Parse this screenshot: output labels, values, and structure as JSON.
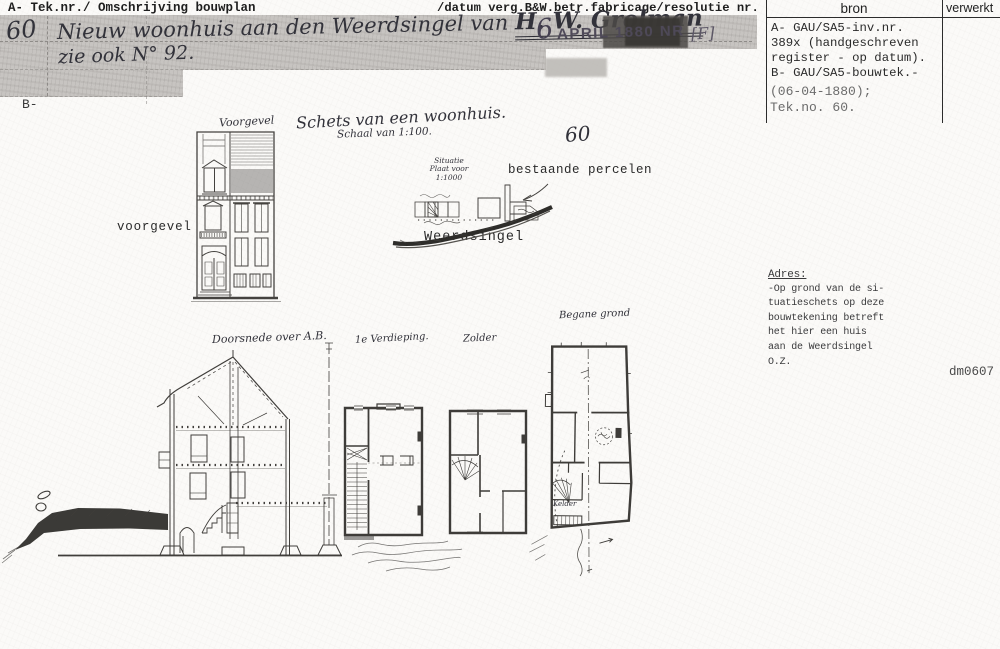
{
  "page": {
    "header_left": "A- Tek.nr./ Omschrijving bouwplan",
    "header_right": "/datum verg.B&W.betr.fabricage/resolutie nr.",
    "section_b_label": "B-",
    "footer_code": "dm0607"
  },
  "register": {
    "bron_header": "bron",
    "verwerkt_header": "verwerkt",
    "bron_line_1": "A- GAU/SA5-inv.nr.",
    "bron_line_2": "389x (handgeschreven",
    "bron_line_3": "register - op datum).",
    "bron_line_4": "B- GAU/SA5-bouwtek.-",
    "bron_line_5": "(06-04-1880);",
    "bron_line_6": "Tek.no. 60."
  },
  "entry": {
    "number": "60",
    "description": "Nieuw woonhuis aan den Weerdsingel van",
    "applicant": "H. W. Grolman",
    "note": "zie ook N° 92.",
    "stamp_day": "6",
    "stamp_text": "APRIL 1880 NR",
    "stamp_mark": "[F]"
  },
  "drawing": {
    "title": "Schets van een woonhuis.",
    "scale_note": "Schaal van 1:100.",
    "sheet_number": "60",
    "label_voorgevel_hand": "Voorgevel",
    "label_voorgevel_typed": "voorgevel",
    "label_situatie": "Situatie Plaat voor 1:1000",
    "label_bestaande_percelen": "bestaande percelen",
    "label_weerdsingel": "Weerdsingel",
    "label_doorsnede": "Doorsnede over A.B.",
    "label_verdieping": "1e Verdieping.",
    "label_zolder": "Zolder",
    "label_begane_grond": "Begane grond",
    "label_kelder": "Kelder"
  },
  "adres": {
    "heading": "Adres:",
    "line_1": "-Op grond van de si-",
    "line_2": "tuatieschets op deze",
    "line_3": "bouwtekening betreft",
    "line_4": "het hier een huis",
    "line_5": "aan de Weerdsingel",
    "line_6": "O.Z."
  }
}
